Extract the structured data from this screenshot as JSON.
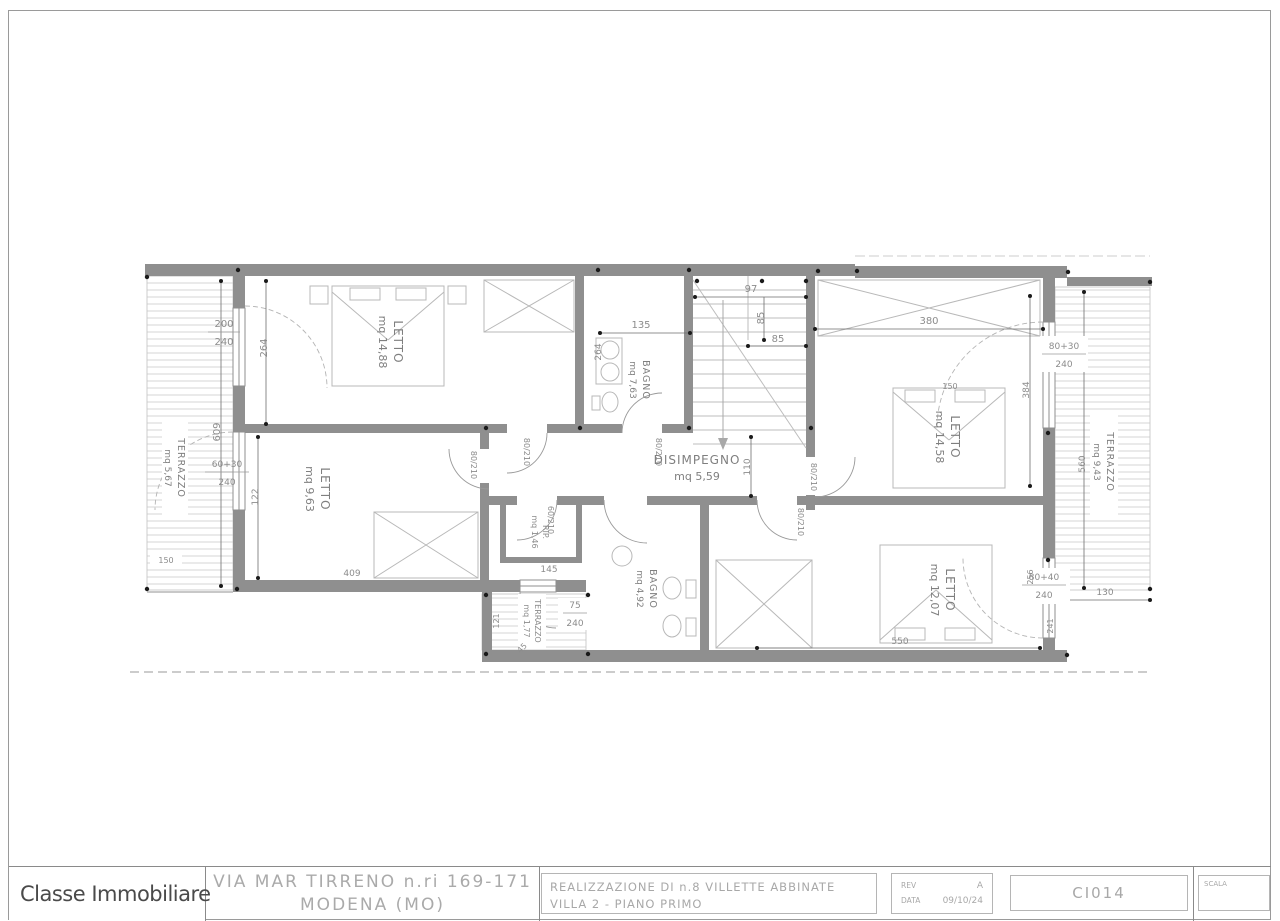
{
  "titleblock": {
    "logo_text": "Classe Immobiliare",
    "address_line1": "VIA MAR TIRRENO n.ri 169-171",
    "address_line2": "MODENA (MO)",
    "project_line1": "REALIZZAZIONE DI n.8 VILLETTE ABBINATE",
    "project_line2": "VILLA 2 - PIANO PRIMO",
    "rev_label": "REV",
    "rev_value": "A",
    "date_label": "DATA",
    "date_value": "09/10/24",
    "drawing_code": "CI014",
    "scale_label": "SCALA"
  },
  "plan": {
    "rooms": {
      "letto1": {
        "name": "LETTO",
        "area": "mq 14,88"
      },
      "bagno1": {
        "name": "BAGNO",
        "area": "mq 7,63"
      },
      "letto2": {
        "name": "LETTO",
        "area": "mq 14,58"
      },
      "letto_left": {
        "name": "LETTO",
        "area": "mq 9,63"
      },
      "rip": {
        "name": "RIP.",
        "area": "mq 1,46"
      },
      "disimpegno": {
        "name": "DISIMPEGNO",
        "area": "mq 5,59"
      },
      "bagno2": {
        "name": "BAGNO",
        "area": "mq 4,92"
      },
      "letto4": {
        "name": "LETTO",
        "area": "mq 12,07"
      },
      "terrazzo_left": {
        "name": "TERRAZZO",
        "area": "mq 5,67"
      },
      "terrazzo_right": {
        "name": "TERRAZZO",
        "area": "mq 9,43"
      },
      "terrazzo_bottom": {
        "name": "TERRAZZO",
        "area": "mq 1,77"
      }
    },
    "dims": {
      "win_nw_w": "200",
      "win_nw_h": "240",
      "win_w2_w": "60+30",
      "win_w2_h": "240",
      "win_e1_w": "80+30",
      "win_e1_h": "240",
      "win_e2_w": "80+40",
      "win_e2_h": "240",
      "win_s_w": "75",
      "win_s_h": "240",
      "d264a": "264",
      "d609": "609",
      "d150l": "150",
      "d135": "135",
      "d264b": "264",
      "d97": "97",
      "d85v": "85",
      "d85h": "85",
      "d380": "380",
      "d384": "384",
      "d560": "560",
      "d110": "110",
      "d122": "122",
      "d145": "145",
      "d409": "409",
      "d121": "121",
      "d45": "45",
      "d550": "550",
      "d130": "130",
      "d256": "256",
      "d241": "241",
      "d150r": "150",
      "door_a": "80/210",
      "door_b": "80/210",
      "door_c": "80/210",
      "door_d": "60/210",
      "door_e": "80/210",
      "door_f": "80/210"
    }
  }
}
